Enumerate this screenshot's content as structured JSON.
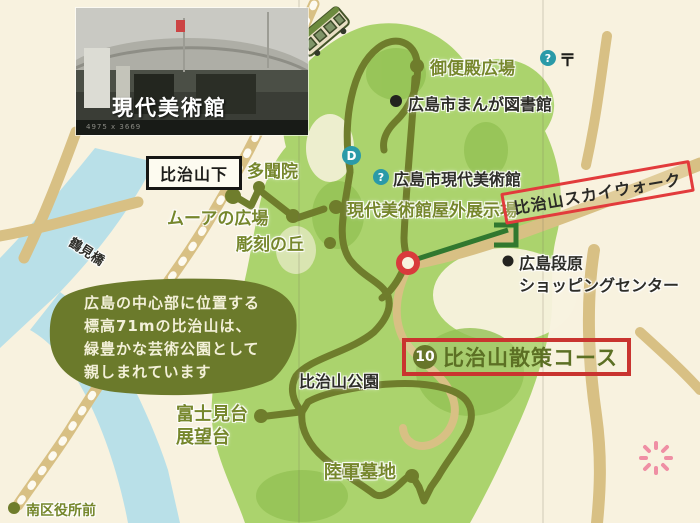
{
  "colors": {
    "background": "#f8f2df",
    "park_green": "#abd36d",
    "park_green_mid": "#93c254",
    "blob_olive": "#6b7a2b",
    "course_olive": "#6f7d2c",
    "road_tan": "#d8c084",
    "river_blue": "#b9e0e8",
    "red_accent": "#d93a3c",
    "info_teal": "#2a9aa8",
    "label_olive": "#76872c",
    "label_dark": "#2e2e29",
    "flower_pink": "#ef8fa4"
  },
  "photo_inset": {
    "caption": "現代美術館",
    "watermark": "4975 x 3669"
  },
  "transit": {
    "station_hijiyamashita": "比治山下",
    "station_minamikuyakusho": "南区役所前",
    "bridge_tsurumi": "鶴見橋"
  },
  "poi": {
    "gobinden_plaza": "御便殿広場",
    "manga_library": "広島市まんが図書館",
    "moca": "広島市現代美術館",
    "moca_outdoor": "現代美術館屋外展示場",
    "tamonin": "多聞院",
    "moore_plaza": "ムーアの広場",
    "sculpture_hill": "彫刻の丘",
    "skywalk": "比治山スカイウォーク",
    "danbara_line1": "広島段原",
    "danbara_line2": "ショッピングセンター",
    "hijiyama_park": "比治山公園",
    "fujimidai_line1": "富士見台",
    "fujimidai_line2": "展望台",
    "army_cemetery": "陸軍墓地"
  },
  "course": {
    "number": "10",
    "title": "比治山散策コース"
  },
  "description": {
    "line1": "広島の中心部に位置する",
    "line2": "標高71mの比治山は、",
    "line3": "緑豊かな芸術公園として",
    "line4": "親しまれています"
  },
  "icons": {
    "info_mark": "?",
    "d_mark": "D",
    "post_mark": "〒"
  }
}
